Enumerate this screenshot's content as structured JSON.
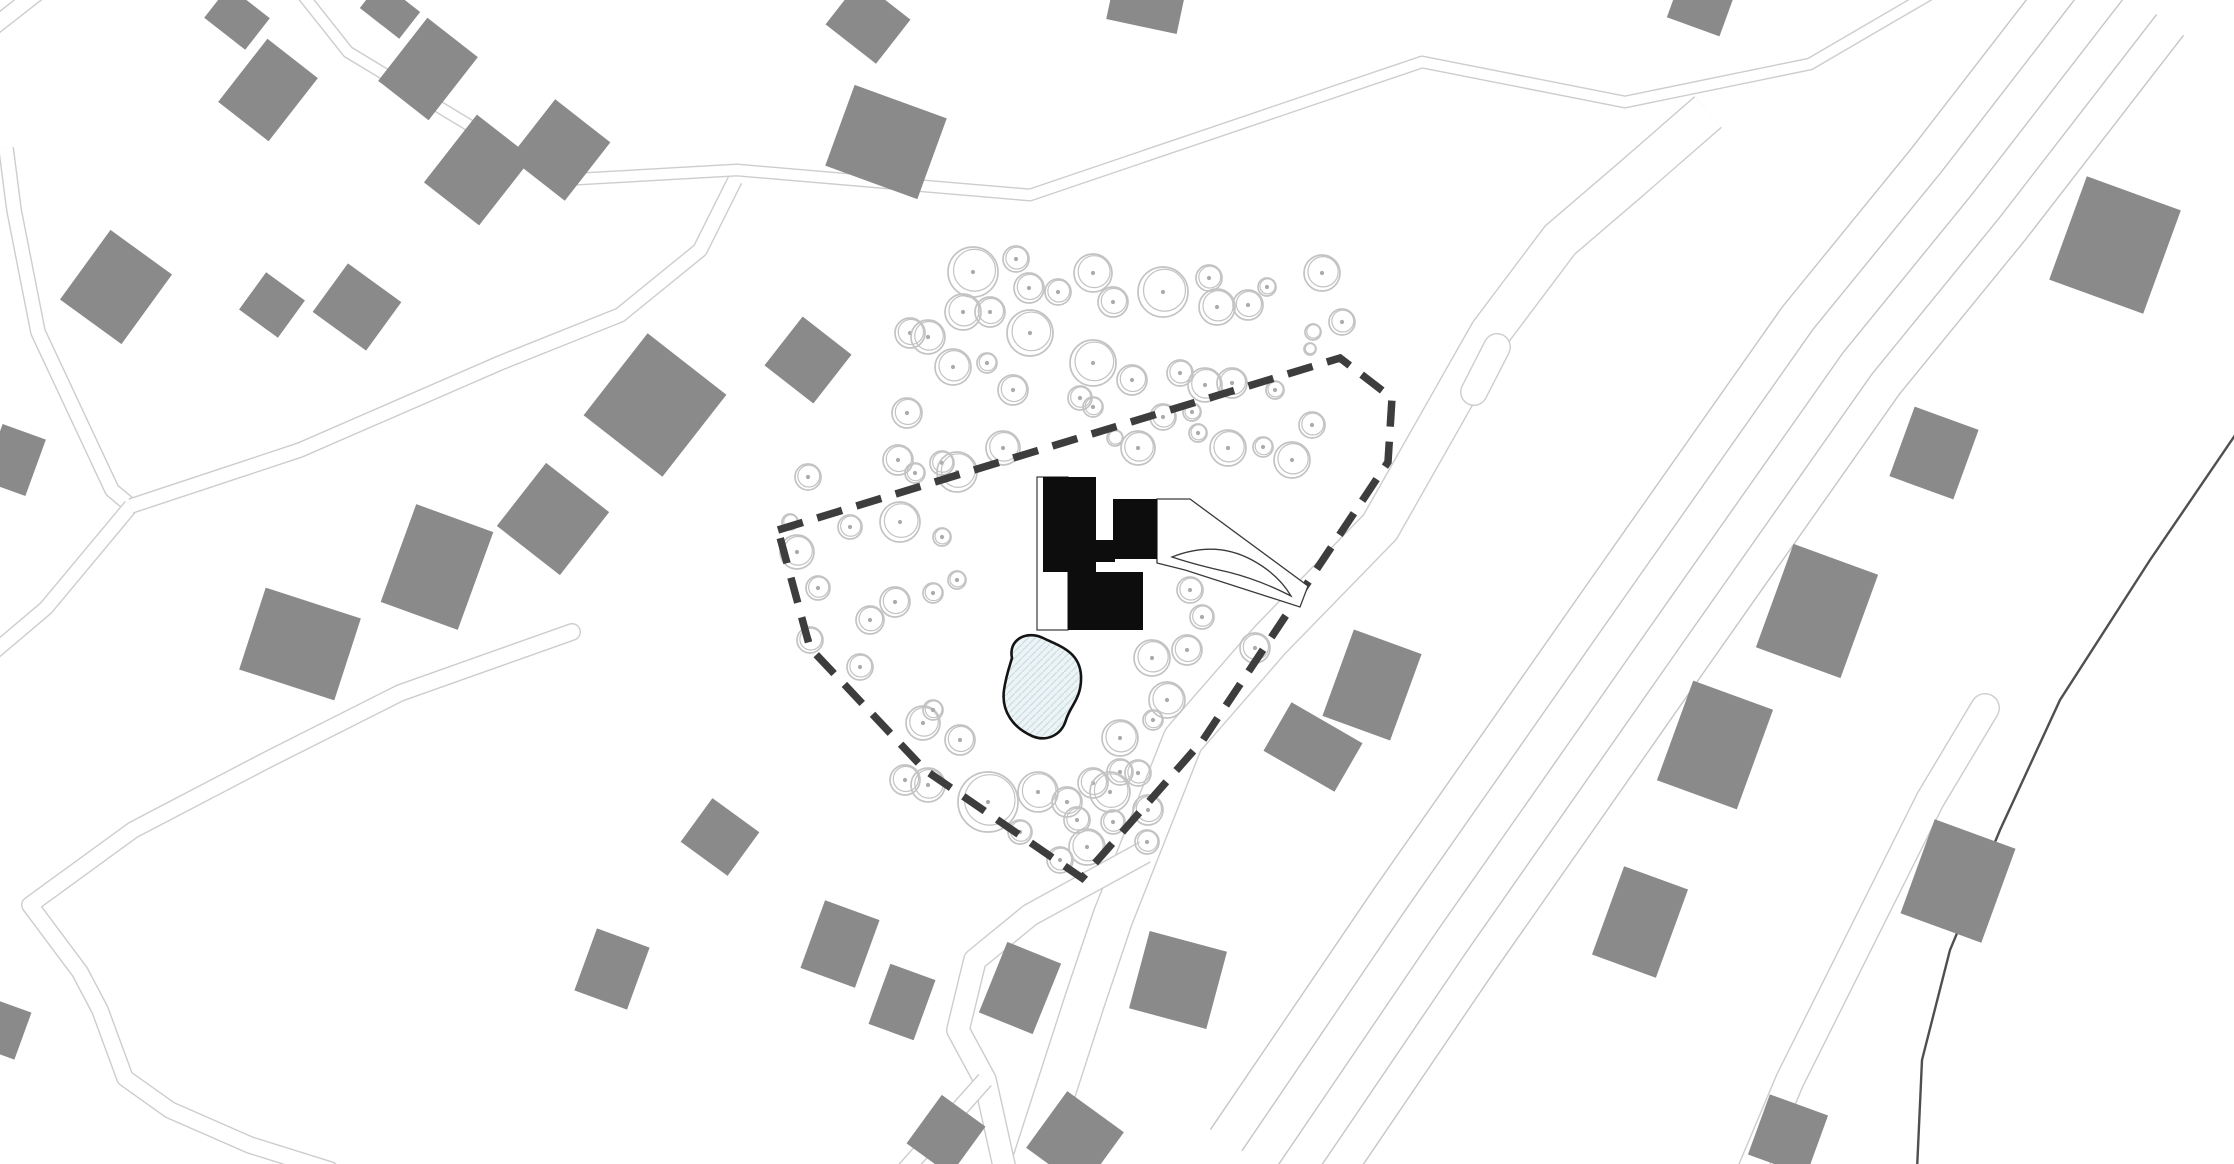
{
  "page": {
    "title": "Residential site plan with proposed building, tree cluster, pond and plot boundary"
  },
  "colors": {
    "background": "#ffffff",
    "existing_building": "#8a8a8a",
    "tree_stroke": "#c3c3c3",
    "tree_dot": "#ababab",
    "road_line": "#cdcdcd",
    "highway_line": "#c6c6c6",
    "boundary_dash": "#3d3d3d",
    "proposed_black": "#0d0d0d",
    "pond_fill": "#edf4f6",
    "pond_hatch": "#c9dde2",
    "pond_stroke": "#141414",
    "stream_line": "#4f4f4f",
    "thin_outline": "#3a3a3a"
  },
  "map": {
    "width": 2234,
    "height": 1164,
    "boundary": {
      "points": [
        [
          778,
          530
        ],
        [
          1340,
          358
        ],
        [
          1392,
          398
        ],
        [
          1388,
          462
        ],
        [
          1203,
          740
        ],
        [
          1082,
          878
        ],
        [
          925,
          770
        ],
        [
          810,
          648
        ]
      ],
      "dash": [
        26,
        15
      ],
      "stroke_width": 7.5
    },
    "roads": [
      {
        "name": "zigzag-road-north",
        "w": 13,
        "cap": "butt",
        "pts": [
          [
            302,
            -6
          ],
          [
            348,
            52
          ],
          [
            560,
            180
          ],
          [
            737,
            170
          ],
          [
            1030,
            195
          ],
          [
            1422,
            62
          ],
          [
            1625,
            102
          ],
          [
            1810,
            64
          ],
          [
            1930,
            -6
          ]
        ]
      },
      {
        "name": "corner-road-northwest",
        "w": 18,
        "cap": "butt",
        "pts": [
          [
            -8,
            28
          ],
          [
            38,
            -8
          ]
        ]
      },
      {
        "name": "west-lane",
        "w": 16,
        "cap": "butt",
        "pts": [
          [
            6,
            148
          ],
          [
            14,
            210
          ],
          [
            38,
            332
          ],
          [
            112,
            490
          ],
          [
            131,
            506
          ]
        ]
      },
      {
        "name": "west-lane-south-branch",
        "w": 16,
        "cap": "butt",
        "pts": [
          [
            131,
            506
          ],
          [
            46,
            608
          ],
          [
            -6,
            652
          ]
        ]
      },
      {
        "name": "diagonal-lane-to-junction",
        "w": 16,
        "cap": "butt",
        "pts": [
          [
            131,
            506
          ],
          [
            300,
            450
          ],
          [
            500,
            363
          ],
          [
            620,
            315
          ],
          [
            700,
            250
          ],
          [
            735,
            180
          ]
        ]
      },
      {
        "name": "southwest-lane",
        "w": 18,
        "cap": "round",
        "pts": [
          [
            572,
            632
          ],
          [
            400,
            693
          ],
          [
            267,
            760
          ],
          [
            133,
            830
          ],
          [
            30,
            905
          ],
          [
            80,
            972
          ],
          [
            100,
            1010
          ],
          [
            125,
            1078
          ],
          [
            170,
            1110
          ],
          [
            250,
            1145
          ],
          [
            330,
            1170
          ]
        ]
      },
      {
        "name": "site-access-road",
        "w": 42,
        "cap": "butt",
        "pts": [
          [
            1030,
            1170
          ],
          [
            1085,
            1000
          ],
          [
            1113,
            917
          ],
          [
            1183,
            740
          ],
          [
            1270,
            640
          ],
          [
            1380,
            527
          ],
          [
            1490,
            333
          ],
          [
            1560,
            240
          ],
          [
            1630,
            180
          ],
          [
            1708,
            112
          ]
        ]
      },
      {
        "name": "south-junction-road",
        "w": 24,
        "cap": "butt",
        "pts": [
          [
            1145,
            852
          ],
          [
            1030,
            915
          ],
          [
            975,
            960
          ],
          [
            958,
            1030
          ],
          [
            985,
            1080
          ],
          [
            1005,
            1170
          ]
        ]
      },
      {
        "name": "south-junction-branch",
        "w": 18,
        "cap": "butt",
        "pts": [
          [
            985,
            1080
          ],
          [
            905,
            1170
          ]
        ]
      },
      {
        "name": "cul-de-sac-southeast",
        "w": 30,
        "cap": "round",
        "pts": [
          [
            1985,
            708
          ],
          [
            1930,
            800
          ],
          [
            1860,
            940
          ],
          [
            1790,
            1080
          ],
          [
            1752,
            1170
          ]
        ]
      },
      {
        "name": "road-stub-east-of-site",
        "w": 28,
        "cap": "round",
        "pts": [
          [
            1497,
            347
          ],
          [
            1474,
            392
          ]
        ]
      }
    ],
    "highway": {
      "centerline": [
        [
          2125,
          -10
        ],
        [
          1968,
          193
        ],
        [
          1840,
          350
        ],
        [
          1650,
          620
        ],
        [
          1433,
          930
        ],
        [
          1270,
          1170
        ]
      ],
      "offsets": [
        -74,
        -40,
        -4,
        34,
        72
      ],
      "stroke_width": 1.4
    },
    "stream": {
      "pts": [
        [
          2240,
          428
        ],
        [
          2150,
          560
        ],
        [
          2060,
          700
        ],
        [
          2000,
          830
        ],
        [
          1950,
          950
        ],
        [
          1922,
          1060
        ],
        [
          1917,
          1170
        ]
      ],
      "stroke_width": 2.4
    },
    "trees": [
      [
        973,
        272,
        25
      ],
      [
        1016,
        259,
        13
      ],
      [
        1029,
        288,
        15
      ],
      [
        1058,
        292,
        13
      ],
      [
        1093,
        273,
        19
      ],
      [
        1113,
        302,
        15
      ],
      [
        1163,
        292,
        25
      ],
      [
        1209,
        278,
        13
      ],
      [
        1217,
        307,
        18
      ],
      [
        1248,
        305,
        15
      ],
      [
        1267,
        287,
        9
      ],
      [
        1322,
        273,
        18
      ],
      [
        1342,
        322,
        13
      ],
      [
        1313,
        332,
        8
      ],
      [
        910,
        333,
        15
      ],
      [
        928,
        337,
        17
      ],
      [
        963,
        312,
        18
      ],
      [
        990,
        312,
        15
      ],
      [
        953,
        367,
        18
      ],
      [
        987,
        363,
        10
      ],
      [
        1030,
        333,
        23
      ],
      [
        1093,
        363,
        23
      ],
      [
        1132,
        380,
        15
      ],
      [
        1180,
        373,
        13
      ],
      [
        1205,
        385,
        17
      ],
      [
        1232,
        383,
        15
      ],
      [
        1275,
        390,
        9
      ],
      [
        1310,
        349,
        6
      ],
      [
        1013,
        390,
        15
      ],
      [
        1080,
        398,
        12
      ],
      [
        1093,
        407,
        10
      ],
      [
        1115,
        438,
        8
      ],
      [
        1138,
        448,
        17
      ],
      [
        1163,
        417,
        13
      ],
      [
        1192,
        412,
        9
      ],
      [
        1198,
        433,
        9
      ],
      [
        1228,
        448,
        18
      ],
      [
        1263,
        447,
        10
      ],
      [
        1292,
        460,
        18
      ],
      [
        1312,
        425,
        13
      ],
      [
        907,
        413,
        15
      ],
      [
        898,
        460,
        15
      ],
      [
        915,
        473,
        10
      ],
      [
        942,
        463,
        12
      ],
      [
        957,
        472,
        20
      ],
      [
        1003,
        448,
        17
      ],
      [
        808,
        477,
        13
      ],
      [
        790,
        522,
        8
      ],
      [
        797,
        552,
        17
      ],
      [
        818,
        588,
        12
      ],
      [
        810,
        640,
        13
      ],
      [
        850,
        527,
        12
      ],
      [
        870,
        620,
        14
      ],
      [
        900,
        522,
        20
      ],
      [
        942,
        537,
        9
      ],
      [
        895,
        602,
        15
      ],
      [
        933,
        593,
        10
      ],
      [
        957,
        580,
        9
      ],
      [
        860,
        667,
        13
      ],
      [
        923,
        723,
        17
      ],
      [
        960,
        740,
        15
      ],
      [
        933,
        710,
        10
      ],
      [
        905,
        780,
        15
      ],
      [
        1113,
        593,
        13
      ],
      [
        1190,
        590,
        13
      ],
      [
        1202,
        617,
        12
      ],
      [
        1255,
        648,
        15
      ],
      [
        1152,
        658,
        18
      ],
      [
        1187,
        650,
        15
      ],
      [
        1167,
        700,
        18
      ],
      [
        1153,
        720,
        10
      ],
      [
        1120,
        738,
        18
      ],
      [
        1093,
        783,
        15
      ],
      [
        1120,
        772,
        13
      ],
      [
        928,
        785,
        17
      ],
      [
        988,
        802,
        30
      ],
      [
        1038,
        792,
        20
      ],
      [
        1067,
        802,
        15
      ],
      [
        1110,
        792,
        20
      ],
      [
        1138,
        773,
        13
      ],
      [
        1148,
        810,
        15
      ],
      [
        1113,
        822,
        12
      ],
      [
        1087,
        847,
        18
      ],
      [
        1060,
        860,
        13
      ],
      [
        1020,
        832,
        12
      ],
      [
        1147,
        842,
        12
      ],
      [
        1077,
        820,
        13
      ]
    ],
    "buildings": [
      [
        237,
        18,
        52,
        40,
        38
      ],
      [
        268,
        90,
        64,
        80,
        38
      ],
      [
        390,
        10,
        50,
        34,
        38
      ],
      [
        428,
        69,
        64,
        80,
        38
      ],
      [
        478,
        170,
        70,
        86,
        38
      ],
      [
        116,
        287,
        76,
        86,
        36
      ],
      [
        272,
        305,
        48,
        46,
        36
      ],
      [
        357,
        307,
        66,
        60,
        36
      ],
      [
        14,
        460,
        46,
        60,
        20
      ],
      [
        560,
        150,
        70,
        74,
        38
      ],
      [
        655,
        405,
        100,
        104,
        38
      ],
      [
        808,
        360,
        62,
        62,
        38
      ],
      [
        553,
        519,
        80,
        80,
        38
      ],
      [
        868,
        22,
        64,
        56,
        38
      ],
      [
        886,
        142,
        98,
        86,
        20
      ],
      [
        437,
        567,
        82,
        104,
        20
      ],
      [
        300,
        644,
        100,
        86,
        18
      ],
      [
        6,
        1030,
        36,
        50,
        20
      ],
      [
        720,
        837,
        58,
        54,
        36
      ],
      [
        612,
        969,
        56,
        66,
        20
      ],
      [
        840,
        944,
        58,
        72,
        20
      ],
      [
        902,
        1002,
        48,
        64,
        20
      ],
      [
        1020,
        988,
        58,
        76,
        22
      ],
      [
        946,
        1135,
        54,
        60,
        36
      ],
      [
        1075,
        1140,
        70,
        70,
        36
      ],
      [
        1178,
        980,
        80,
        80,
        15
      ],
      [
        1313,
        747,
        82,
        56,
        30
      ],
      [
        1372,
        685,
        72,
        92,
        20
      ],
      [
        1934,
        453,
        68,
        74,
        20
      ],
      [
        1817,
        611,
        90,
        110,
        20
      ],
      [
        1715,
        745,
        85,
        106,
        20
      ],
      [
        1640,
        922,
        68,
        94,
        20
      ],
      [
        1958,
        881,
        86,
        100,
        20
      ],
      [
        1788,
        1135,
        62,
        64,
        20
      ],
      [
        2115,
        245,
        100,
        110,
        20
      ],
      [
        1700,
        8,
        56,
        40,
        20
      ],
      [
        1146,
        5,
        72,
        44,
        12
      ]
    ],
    "proposed_building": {
      "black_blocks": [
        [
          1043,
          477,
          53,
          95
        ],
        [
          1093,
          540,
          22,
          22
        ],
        [
          1113,
          499,
          44,
          60
        ],
        [
          1068,
          572,
          75,
          58
        ]
      ],
      "court_outline": [
        1037,
        477,
        31,
        153
      ],
      "driveway_wedge": [
        [
          1157,
          499
        ],
        [
          1190,
          499
        ],
        [
          1308,
          586
        ],
        [
          1300,
          607
        ],
        [
          1185,
          570
        ],
        [
          1157,
          563
        ]
      ],
      "driveway_leaf": "M1172 557 Q1215 540 1252 560 Q1278 574 1291 596 Q1260 580 1228 572 Q1196 565 1172 557 Z"
    },
    "pond": {
      "path": "M1012 658 C1008 640 1026 630 1043 638 C1060 646 1080 652 1081 676 C1082 698 1070 706 1066 720 C1061 736 1046 742 1032 736 C1014 728 1001 712 1004 690 C1006 676 1009 668 1012 658 Z",
      "stroke_width": 2.6
    }
  }
}
